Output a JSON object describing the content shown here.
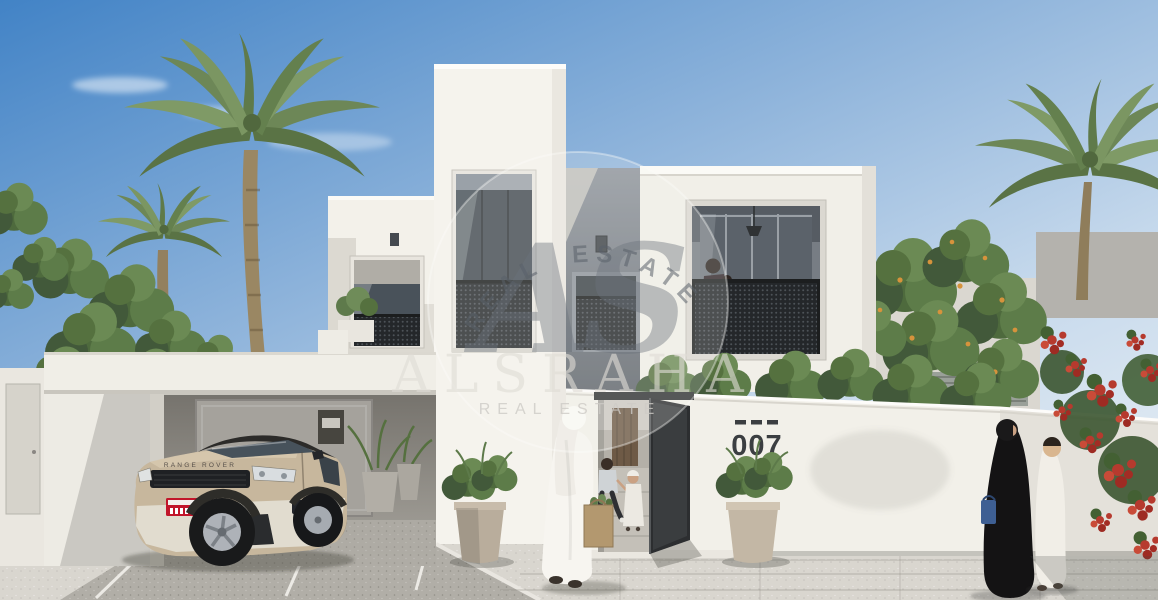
{
  "watermark": {
    "monogram": "AS",
    "arc_text": "REAL ESTATE",
    "brand_text": "ALSRAHA",
    "sub_text": "REAL ESTATE"
  },
  "villa": {
    "house_number": "007"
  },
  "car": {
    "hood_text": "RANGE ROVER"
  },
  "colors": {
    "sky_top": "#4283c6",
    "sky_horizon": "#e7eef4",
    "wall_sunlit": "#f2f0e9",
    "wall_shaded": "#d9d6ce",
    "facade_recess": "#6f757d",
    "mesh_dark": "#24272a",
    "gate_dark": "#2c2e30",
    "car_body": "#c7b79d",
    "palm_green": "#6d8757",
    "bougainvillea_red": "#b63a2e",
    "paving_light": "#d9d6cf",
    "paving_shade": "#b1aea7"
  }
}
